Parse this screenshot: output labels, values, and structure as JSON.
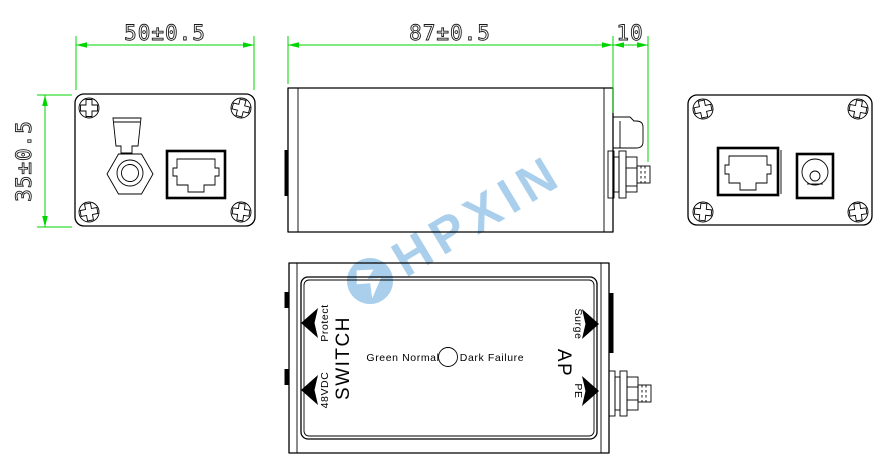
{
  "drawing_title": "Surge protector outline drawing (front / side / back / top views)",
  "dimensions": {
    "front_width": "50±0.5",
    "front_height": "35±0.5",
    "body_length": "87±0.5",
    "connector_length": "10"
  },
  "top_view": {
    "switch_label": "SWITCH",
    "protect_label": "Protect",
    "power_label": "48VDC",
    "ap_label": "AP",
    "surge_label": "Surge",
    "pe_label": "PE",
    "led_green_label": "Green Normal",
    "led_dark_label": "Dark Failure"
  },
  "watermark": {
    "text": "HPXIN",
    "color": "#a9cfec"
  },
  "colors": {
    "dimension_lines": "#00d500",
    "drawing_lines": "#000000",
    "background": "#ffffff"
  },
  "icons": [
    "corner-screw-icon",
    "coax-connector-icon",
    "rj45-port-icon",
    "dc-jack-icon",
    "led-indicator-icon",
    "direction-arrow-icon",
    "lightning-logo-icon"
  ]
}
